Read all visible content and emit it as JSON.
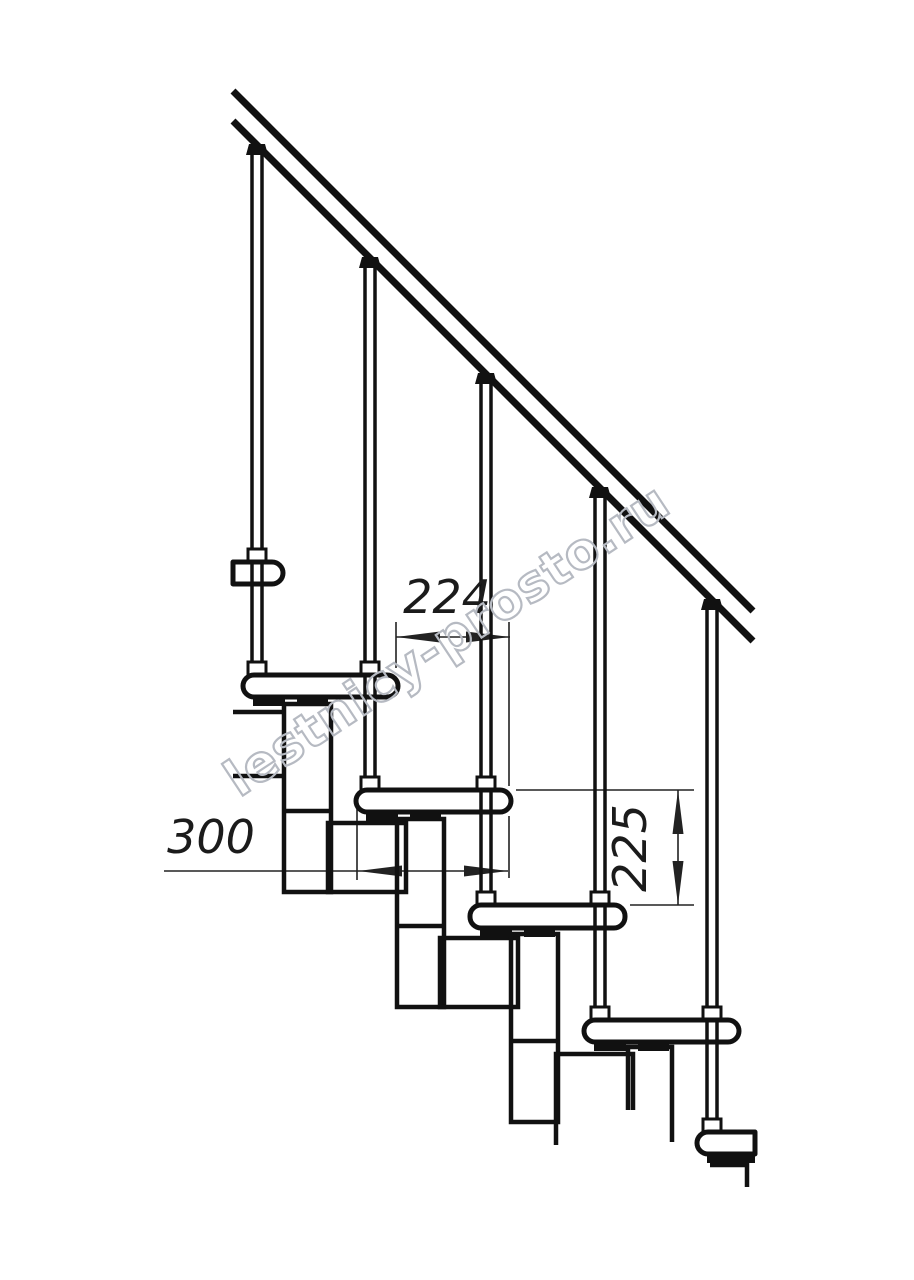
{
  "drawing": {
    "kind": "modular staircase side-view technical drawing",
    "units": "mm"
  },
  "dimensions": {
    "going": {
      "value": "224",
      "meaning": "horizontal distance between tread noses"
    },
    "tread_depth": {
      "value": "300",
      "meaning": "tread depth"
    },
    "rise": {
      "value": "225",
      "meaning": "step rise between tread tops"
    }
  },
  "watermark": {
    "text": "lestnicy-prosto.ru"
  },
  "colors": {
    "line": "#111111",
    "dimension_line": "#222222",
    "watermark_outline": "#b6bac2",
    "background": "#ffffff"
  }
}
